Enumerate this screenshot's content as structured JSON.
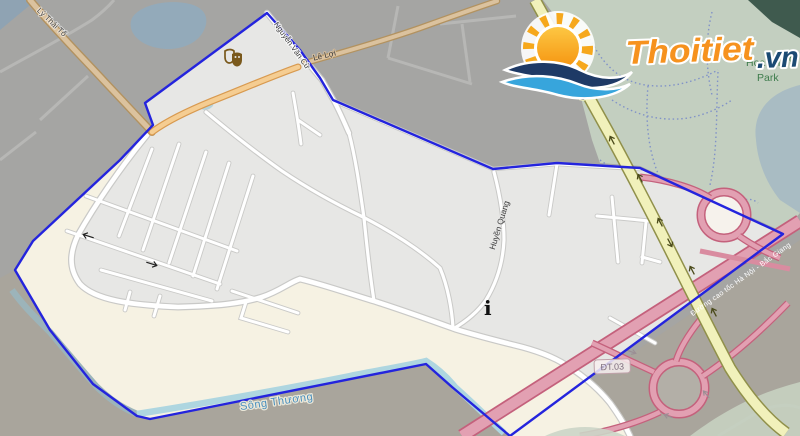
{
  "map": {
    "labels": {
      "ly_thai_to": "Lý Thái Tổ",
      "nguyen_van_cu": "Nguyễn Văn Cừ",
      "le_loi": "Lê Lợi",
      "huyen_quang": "Huyền Quang",
      "uong_fragment": "ương",
      "song_thuong": "Sông Thương",
      "highway": "Đường cao tốc Hà Nội - Bắc Giang",
      "route_badge": "ĐT.03",
      "park_line1": "Hoa Tha",
      "park_line2": "Park",
      "park_fragment_g": "g",
      "info_glyph": "i"
    },
    "icons": {
      "theater": "theater-masks-icon",
      "info": "info-point-icon",
      "one_way": "one-way-arrow-icon"
    }
  },
  "logo": {
    "brand": "Thoitiet",
    "tld": ".vn"
  },
  "colors": {
    "boundary": "#2424dd",
    "urban_fill": "#e7e7e5",
    "floodplain": "#f6f2e3",
    "outside_north": "#a5a5a3",
    "outside_south": "#a9a59c",
    "park": "#c3cfc0",
    "park_dark": "#3f5a4e",
    "lake": "#a9bcc3",
    "river": "#aed6e0",
    "water": "#93aaba",
    "highway_fill": "#e2a0b2",
    "highway_casing": "#c4617c",
    "yellow_road": "#f1f1bb",
    "orange_road": "#f5cd92",
    "tan_road": "#dbc29e",
    "label_green": "#3e7c4c",
    "label_blue": "#4a8fbe",
    "logo_orange": "#f6921e",
    "logo_navy": "#1b4a73"
  }
}
